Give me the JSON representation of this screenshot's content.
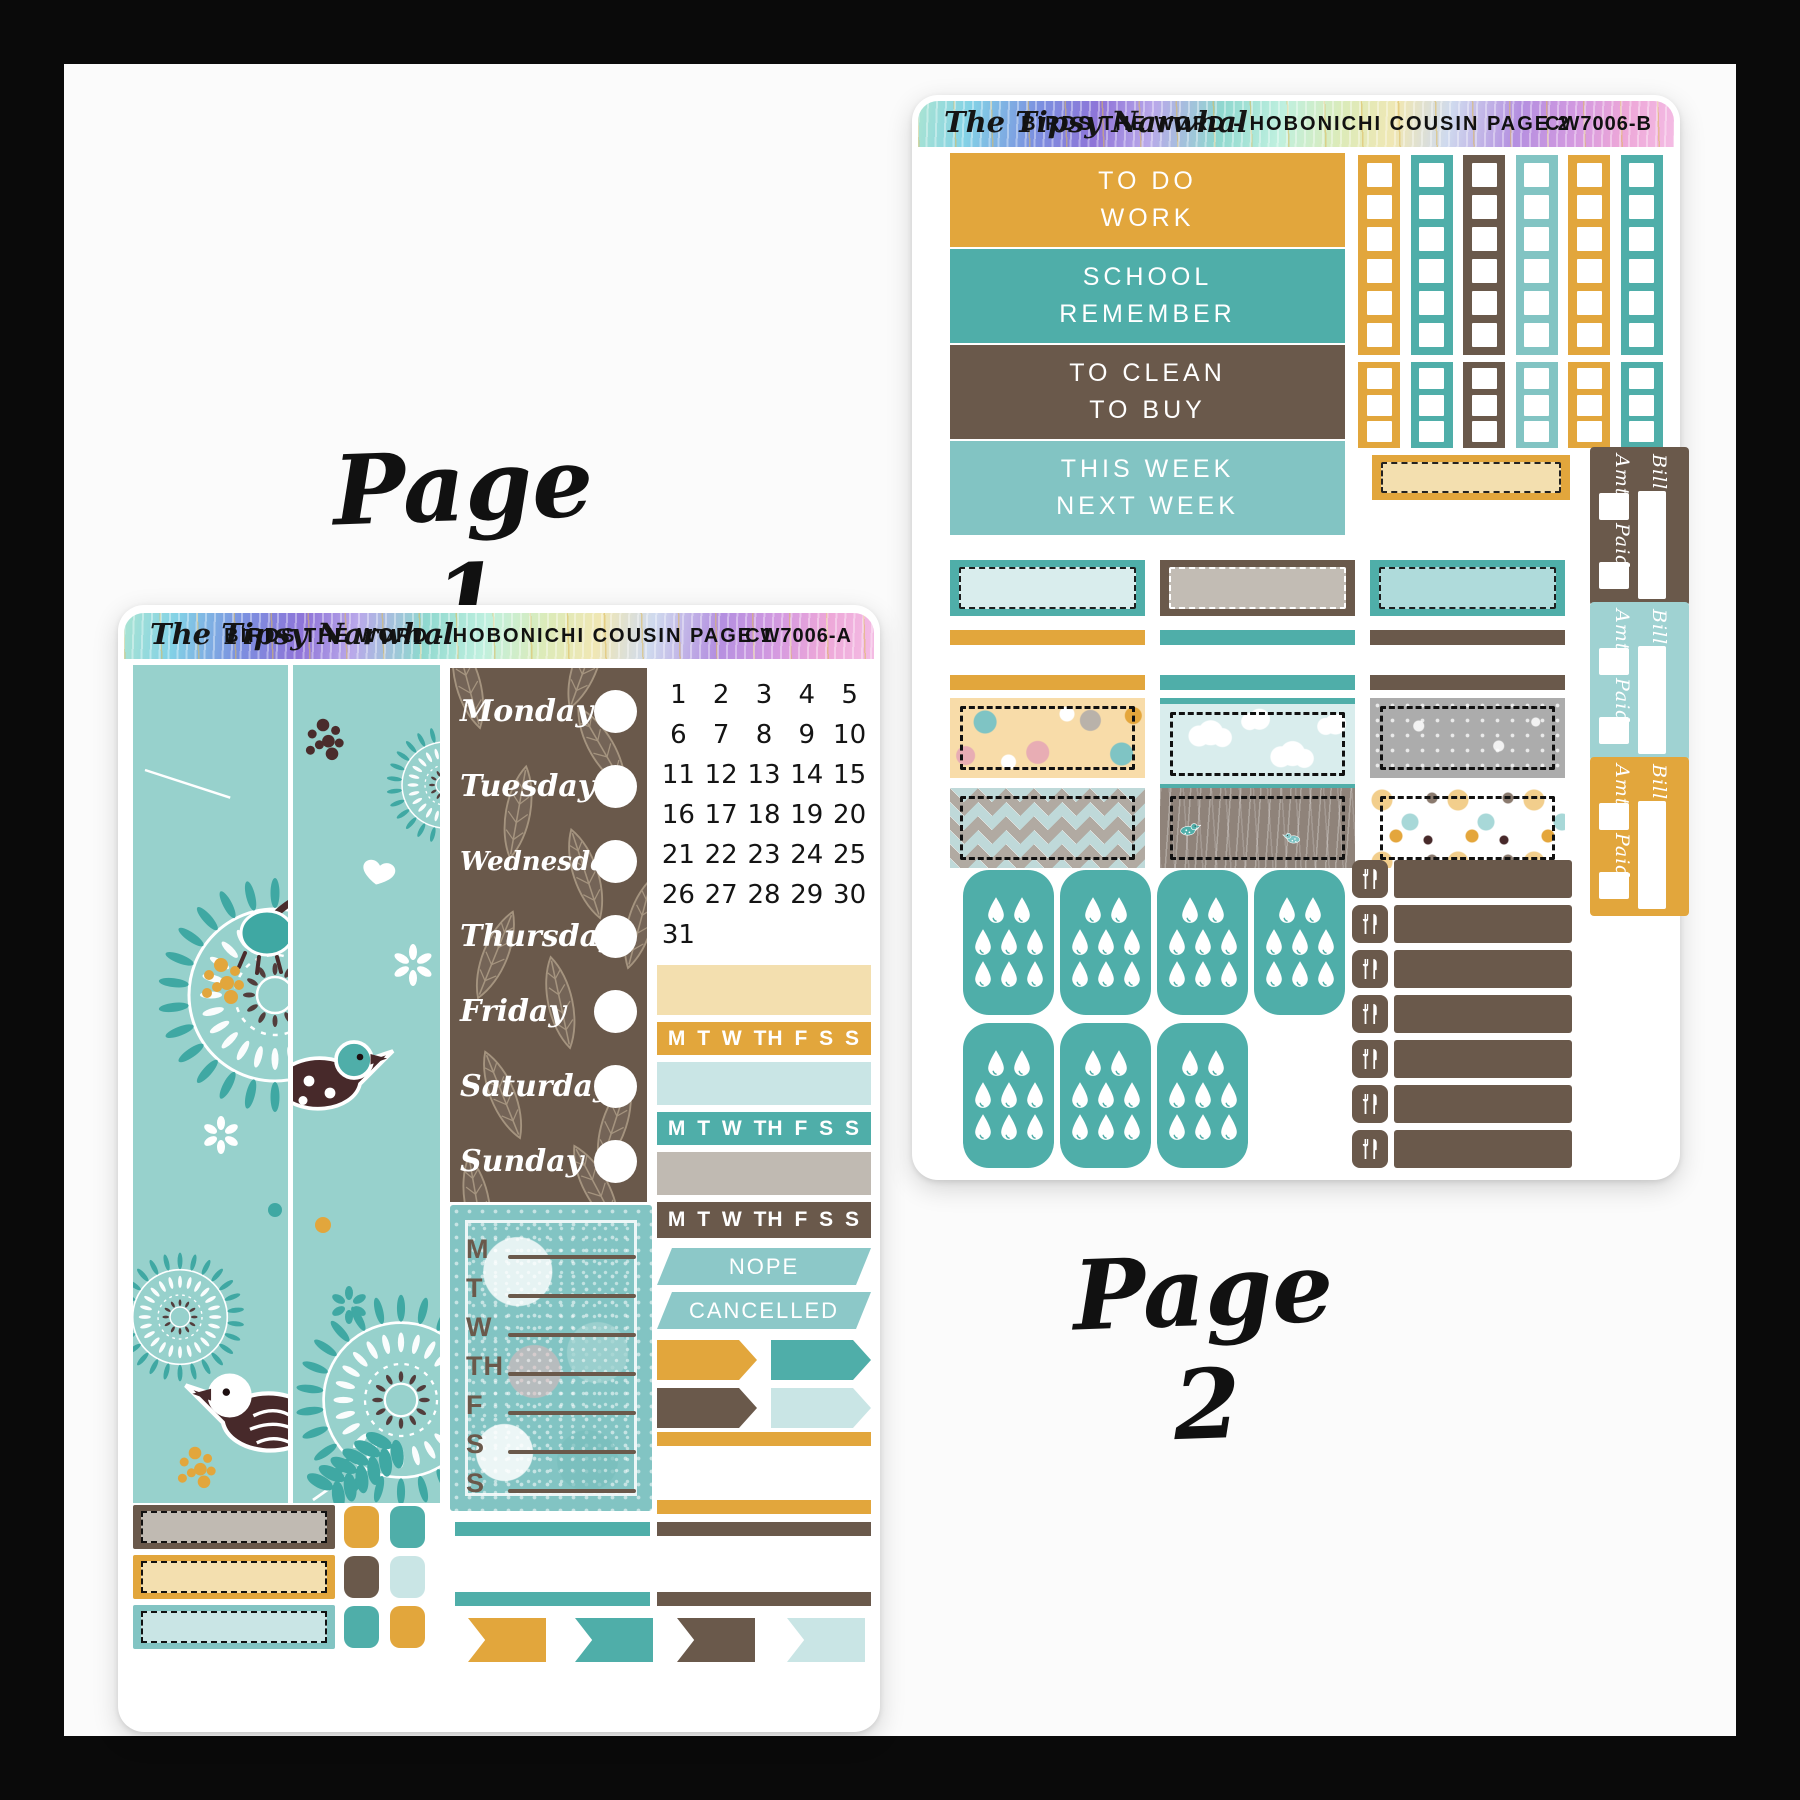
{
  "brand": "The Tipsy Narwhal",
  "page_labels": {
    "page1": "Page 1",
    "page2": "Page 2"
  },
  "palette": {
    "gold": "#E2A63C",
    "teal": "#4FAEA9",
    "brown": "#6A594B",
    "light_teal": "#82C4C3",
    "pale_teal": "#9FD2D2",
    "pale_blue": "#C9E5E5",
    "cream": "#F3DFAF",
    "gray": "#C0BAB2",
    "dark_brown": "#47292A",
    "floral_bg": "#97D1CC",
    "floral_leaf": "#3FA8A3",
    "flag_teal": "#8CC8C8",
    "frame": "#0A0A0A",
    "canvas": "#FBFBFB",
    "sheet": "#FFFFFF"
  },
  "sheet1": {
    "title": "BIRDS THE WORD - HOBONICHI COUSIN PAGE 1",
    "code": "CW7006-A",
    "weekdays": [
      "Monday",
      "Tuesday",
      "Wednesday",
      "Thursday",
      "Friday",
      "Saturday",
      "Sunday"
    ],
    "dates": [
      "1",
      "2",
      "3",
      "4",
      "5",
      "6",
      "7",
      "8",
      "9",
      "10",
      "11",
      "12",
      "13",
      "14",
      "15",
      "16",
      "17",
      "18",
      "19",
      "20",
      "21",
      "22",
      "23",
      "24",
      "25",
      "26",
      "27",
      "28",
      "29",
      "30",
      "31"
    ],
    "habit_letters": [
      "M",
      "T",
      "W",
      "TH",
      "F",
      "S",
      "S"
    ],
    "tracker_strips": [
      {
        "color": "cream",
        "letters": false
      },
      {
        "color": "gold",
        "letters": true
      },
      {
        "color": "pale_blue",
        "letters": false
      },
      {
        "color": "teal",
        "letters": true
      },
      {
        "color": "gray",
        "letters": false
      },
      {
        "color": "brown",
        "letters": true
      }
    ],
    "weekly_list_letters": [
      "M",
      "T",
      "W",
      "TH",
      "F",
      "S",
      "S"
    ],
    "flags": {
      "nope": "NOPE",
      "cancelled": "CANCELLED"
    },
    "arrow_flag_rows": [
      [
        "gold",
        "teal"
      ],
      [
        "brown",
        "pale_blue"
      ]
    ],
    "right_thin_strips": [
      "gold",
      "gold",
      "brown",
      "brown"
    ],
    "mid_thin_strips": [
      "teal",
      "teal"
    ],
    "pennant_flags": [
      "gold",
      "teal",
      "brown",
      "pale_blue"
    ],
    "dashed_boxes": [
      {
        "border": "brown",
        "fill": "gray"
      },
      {
        "border": "gold",
        "fill": "cream"
      },
      {
        "border": "light_teal",
        "fill": "pale_blue"
      }
    ],
    "square_rows": [
      [
        "gold",
        "teal"
      ],
      [
        "brown",
        "pale_blue"
      ],
      [
        "teal",
        "gold"
      ]
    ],
    "icons": [
      "bird-icon",
      "heart-icon",
      "mandala-icon",
      "leaf-icon",
      "date-dot-circle"
    ]
  },
  "sheet2": {
    "title": "BIRDS THE WORD - HOBONICHI COUSIN PAGE 2",
    "code": "CW7006-B",
    "category_blocks": [
      {
        "color": "gold",
        "labels": [
          "TO DO",
          "WORK"
        ]
      },
      {
        "color": "teal",
        "labels": [
          "SCHOOL",
          "REMEMBER"
        ]
      },
      {
        "color": "brown",
        "labels": [
          "TO CLEAN",
          "TO BUY"
        ]
      },
      {
        "color": "light_teal",
        "labels": [
          "THIS WEEK",
          "NEXT WEEK"
        ]
      }
    ],
    "checkbox_strip_colors": [
      "gold",
      "teal",
      "brown",
      "light_teal",
      "gold",
      "teal"
    ],
    "checkboxes_long": 6,
    "checkboxes_short": 3,
    "cream_washi": {
      "border": "gold",
      "fill": "cream"
    },
    "washi_boxes": [
      {
        "border": "teal",
        "fill": "#D9EDED",
        "dash": "#1d1d1d"
      },
      {
        "border": "brown",
        "fill": "#C2BCB4",
        "dash": "#ffffff"
      },
      {
        "border": "teal",
        "fill": "#AFDBDB",
        "dash": "#1d1d1d"
      }
    ],
    "thin_strip_rows": [
      [
        "gold",
        "teal",
        "brown"
      ],
      [
        "gold",
        "teal",
        "brown"
      ]
    ],
    "patterned_boxes": [
      "peach-floral",
      "clouds",
      "gray-floral",
      "chevron",
      "meadow-birds",
      "polka-dots"
    ],
    "bill_labels": {
      "bill": "Bill",
      "amt": "Amt.",
      "paid": "Paid"
    },
    "bill_sticker_colors": [
      "brown",
      "pale_teal",
      "gold"
    ],
    "hydrate": {
      "row_counts": [
        4,
        3
      ],
      "drops_per_sticker": 8,
      "icon": "water-drop-icon"
    },
    "meal_rows": 7,
    "meal_icon": "fork-knife-icon"
  }
}
